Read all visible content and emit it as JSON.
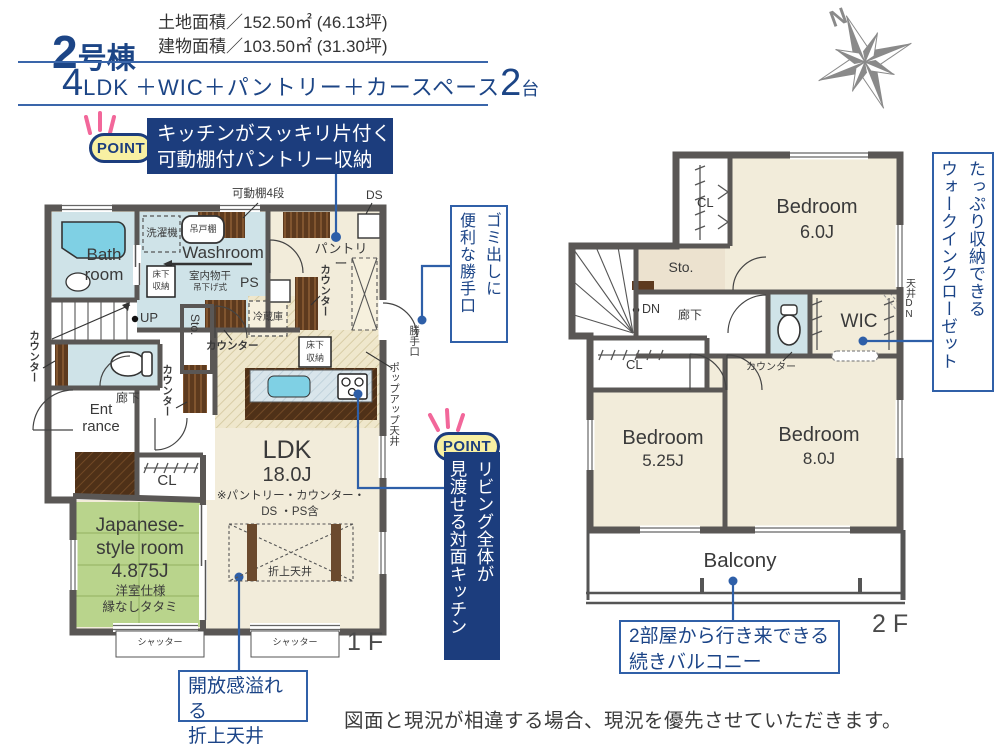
{
  "header": {
    "building_number": "2",
    "building_suffix": "号棟",
    "land_area": "土地面積／152.50㎡ (46.13坪)",
    "building_area": "建物面積／103.50㎡ (31.30坪)",
    "layout": {
      "rooms": "4",
      "ldk": "LDK",
      "extras": "＋WIC＋パントリー＋カースペース",
      "cars": "2",
      "cars_unit": "台"
    }
  },
  "points": {
    "point_label": "POINT",
    "p1": {
      "line1": "キッチンがスッキリ片付く",
      "line2": "可動棚付パントリー収納"
    },
    "p2": {
      "line1": "リビング全体が",
      "line2": "見渡せる対面キッチン"
    }
  },
  "callouts": {
    "back_door": {
      "line1": "ゴミ出しに",
      "line2": "便利な勝手口"
    },
    "ceiling": {
      "line1": "開放感溢れる",
      "line2": "折上天井"
    },
    "balcony": {
      "line1": "2部屋から行き来できる",
      "line2": "続きバルコニー"
    },
    "wic": {
      "line1": "たっぷり収納できる",
      "line2": "ウォークインクローゼット"
    }
  },
  "floor1": {
    "bath": "Bath\nroom",
    "washroom": "Washroom",
    "laundry": "洗濯機",
    "hanging_shelf": "吊戸棚",
    "underfloor_storage": "床下\n収納",
    "indoor_drying": "室内物干",
    "drying_type": "吊下げ式",
    "ps": "PS",
    "movable_shelf": "可動棚4段",
    "ds": "DS",
    "pantry": "パントリー",
    "counter": "カウンター",
    "fridge": "冷蔵庫",
    "popup_ceiling": "ポップアップ天井",
    "back_door": "勝手口",
    "up": "UP",
    "storage": "Sto.",
    "hallway": "廊下",
    "entrance": "Ent\nrance",
    "closet": "CL",
    "japanese_room": "Japanese-\nstyle room\n4.875J",
    "japanese_note1": "洋室仕様",
    "japanese_note2": "縁なしタタミ",
    "ldk": "LDK",
    "ldk_size": "18.0J",
    "ldk_note1": "※パントリー・カウンター・",
    "ldk_note2": "DS ・PS含",
    "coffered_ceiling": "折上天井",
    "shutter": "シャッター",
    "floor_label": "1 F"
  },
  "floor2": {
    "closet": "CL",
    "storage": "Sto.",
    "dn": "DN",
    "hallway": "廊下",
    "counter": "カウンター",
    "wic": "WIC",
    "ceiling_dn": "天井DN",
    "bedroom1_name": "Bedroom",
    "bedroom1_size": "6.0J",
    "bedroom2_name": "Bedroom",
    "bedroom2_size": "5.25J",
    "bedroom3_name": "Bedroom",
    "bedroom3_size": "8.0J",
    "balcony": "Balcony",
    "floor_label": "2 F"
  },
  "compass": {
    "north": "N"
  },
  "footer": {
    "disclaimer": "図面と現況が相違する場合、現況を優先させていただきます。"
  },
  "palette": {
    "navy": "#1c3d7d",
    "callout_blue": "#3060a8",
    "header_blue": "#1c4586",
    "wall_gray": "#5a5755",
    "room_beige": "#f2ecda",
    "wet_blue": "#cfe3e8",
    "tatami_green": "#b9d48c",
    "wood_brown": "#5d3a1e",
    "accent_pink": "#f2679a",
    "tub_cyan": "#7fd0e4",
    "compass_gray": "#8a8a8a"
  }
}
